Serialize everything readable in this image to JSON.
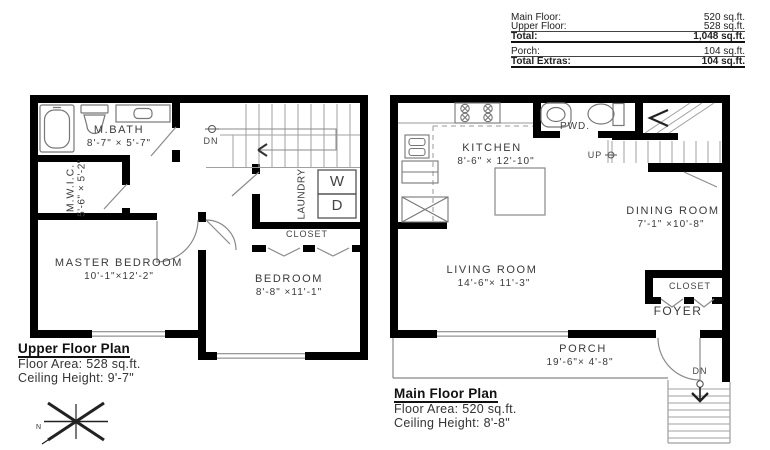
{
  "summary": {
    "rows": [
      {
        "label": "Main Floor:",
        "value": "520 sq.ft."
      },
      {
        "label": "Upper Floor:",
        "value": "528 sq.ft."
      },
      {
        "label": "Total:",
        "value": "1,048 sq.ft."
      },
      {
        "label": "Porch:",
        "value": "104 sq.ft."
      },
      {
        "label": "Total Extras:",
        "value": "104 sq.ft."
      }
    ]
  },
  "upper_floor": {
    "title": "Upper Floor Plan",
    "floor_area": "Floor Area: 528 sq.ft.",
    "ceiling_height": "Ceiling Height: 9'-7\"",
    "rooms": {
      "mbath": {
        "name": "M.BATH",
        "dims": "8'-7\" × 5'-7\""
      },
      "mwic": {
        "name": "M.W.I.C.",
        "dims": "5'-6\" × 5'-2\""
      },
      "master_bedroom": {
        "name": "MASTER BEDROOM",
        "dims": "10'-1\"×12'-2\""
      },
      "bedroom": {
        "name": "BEDROOM",
        "dims": "8'-8\" ×11'-1\""
      },
      "laundry": {
        "name": "LAUNDRY"
      },
      "closet": {
        "name": "CLOSET"
      }
    },
    "labels": {
      "dn": "DN",
      "washer": "W",
      "dryer": "D"
    }
  },
  "main_floor": {
    "title": "Main Floor Plan",
    "floor_area": "Floor Area: 520 sq.ft.",
    "ceiling_height": "Ceiling Height: 8'-8\"",
    "rooms": {
      "kitchen": {
        "name": "KITCHEN",
        "dims": "8'-6\" × 12'-10\""
      },
      "pwd": {
        "name": "PWD."
      },
      "dining_room": {
        "name": "DINING ROOM",
        "dims": "7'-1\" ×10'-8\""
      },
      "living_room": {
        "name": "LIVING ROOM",
        "dims": "14'-6\"× 11'-3\""
      },
      "closet": {
        "name": "CLOSET"
      },
      "foyer": {
        "name": "FOYER"
      },
      "porch": {
        "name": "PORCH",
        "dims": "19'-6\"× 4'-8\""
      }
    },
    "labels": {
      "up": "UP",
      "dn": "DN"
    }
  },
  "compass": {
    "north": "N"
  },
  "colors": {
    "wall": "#000000",
    "fixture_line": "#777777",
    "text": "#3a3a3a"
  }
}
